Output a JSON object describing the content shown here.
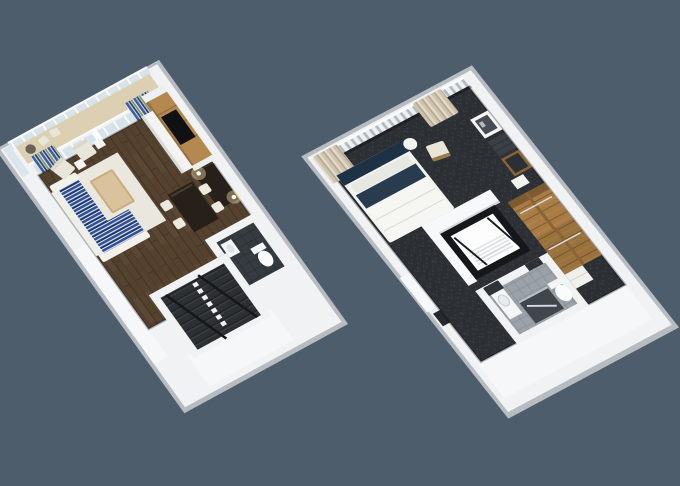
{
  "scene": {
    "type": "3d-floorplan-rendering",
    "units": [
      {
        "id": "lower-level",
        "position": "left",
        "rooms": [
          {
            "name": "balcony",
            "furniture": [
              "bistro-table",
              "deck-chair"
            ]
          },
          {
            "name": "living-room",
            "furniture": [
              "sectional-sofa-navy-stripe",
              "chaise-lounge",
              "coffee-table",
              "armchair",
              "armchair",
              "side-table",
              "side-table",
              "area-rug",
              "tv",
              "tv-wood-panel",
              "media-console",
              "striped-curtain",
              "striped-curtain",
              "double-height-window-wall"
            ]
          },
          {
            "name": "dining-area",
            "furniture": [
              "dining-table",
              "dining-chair",
              "dining-chair",
              "dining-chair",
              "dining-chair",
              "sideboard",
              "table-lamp",
              "table-lamp"
            ]
          },
          {
            "name": "bathroom",
            "furniture": [
              "toilet",
              "sink"
            ]
          },
          {
            "name": "staircase",
            "furniture": [
              "stair-treads",
              "white-balusters",
              "black-handrail",
              "black-handrail"
            ]
          }
        ]
      },
      {
        "id": "upper-level",
        "position": "right",
        "rooms": [
          {
            "name": "bedroom",
            "furniture": [
              "bed",
              "navy-headboard",
              "navy-throw",
              "armchair",
              "round-side-table",
              "artwork",
              "accent-panel",
              "wall-mirror",
              "nightstand",
              "beige-curtain",
              "beige-curtain",
              "overlook-slat-railing"
            ]
          },
          {
            "name": "stairwell",
            "furniture": [
              "black-railing",
              "stairs"
            ]
          },
          {
            "name": "bathroom",
            "furniture": [
              "vanity-sink",
              "vanity-mirror",
              "shower",
              "grab-bar",
              "toilet"
            ]
          },
          {
            "name": "walk-in-closet",
            "furniture": [
              "wardrobe",
              "wardrobe",
              "dresser"
            ]
          }
        ]
      }
    ]
  },
  "palette": {
    "background": "#4e5d6c",
    "wall": "#f1f2f3",
    "wall_outer": "#b7bcc1",
    "wall_face": "#f6f7f8",
    "wall_shade": "#d5d8db",
    "white_soft": "#fafbfc",
    "glass": "#d7e3ea",
    "balcony_floor": "#dccfb2",
    "wood_floor": "#54422f",
    "wood_floor_line": "#433528",
    "wood_floor_light": "#64503c",
    "rug": "#eae7df",
    "sofa_navy": "#30509a",
    "sofa_navy_dark": "#1e3a6d",
    "sofa_stripe_light": "#e9edf4",
    "cream": "#e9e6d9",
    "light_oak": "#c9ad82",
    "oak_top": "#dac29c",
    "tv_panel_oak": "#b5884f",
    "tv_groove": "#8f6a3c",
    "tv_black": "#0f1113",
    "espresso": "#27201a",
    "lamp_glow": "#ffe9b0",
    "stair_dark": "#2d3033",
    "tread_dark": "#1f2225",
    "tread_light": "#3b3f44",
    "rail_black": "#15171a",
    "carpet": "#2c2f33",
    "carpet_light": "#3a3e43",
    "bed_navy": "#1e3246",
    "bed_white": "#f2f2ef",
    "pillow": "#e8e8e2",
    "curtain_blue": "#3a5fa0",
    "curtain_navy": "#223f6e",
    "curtain_olive": "#7d8f66",
    "curtain_base": "#e6e6e0",
    "curtain_beige": "#cfc3ae",
    "curtain_beige_dark": "#b3a68e",
    "curtain_beige_light": "#e2dac9",
    "slat_white": "#eef0f2",
    "slat_gap": "#b2bac0",
    "closet_wood": "#a87c44",
    "closet_wood_dark": "#7d5b30",
    "closet_wood_light": "#b98d52",
    "tile": "#9ba2aa",
    "tile_line": "#8a9199",
    "tile_dark": "#363b41",
    "tile_dark_line": "#2b3036",
    "shower_dark": "#41464d",
    "chrome": "#d7dbde"
  }
}
